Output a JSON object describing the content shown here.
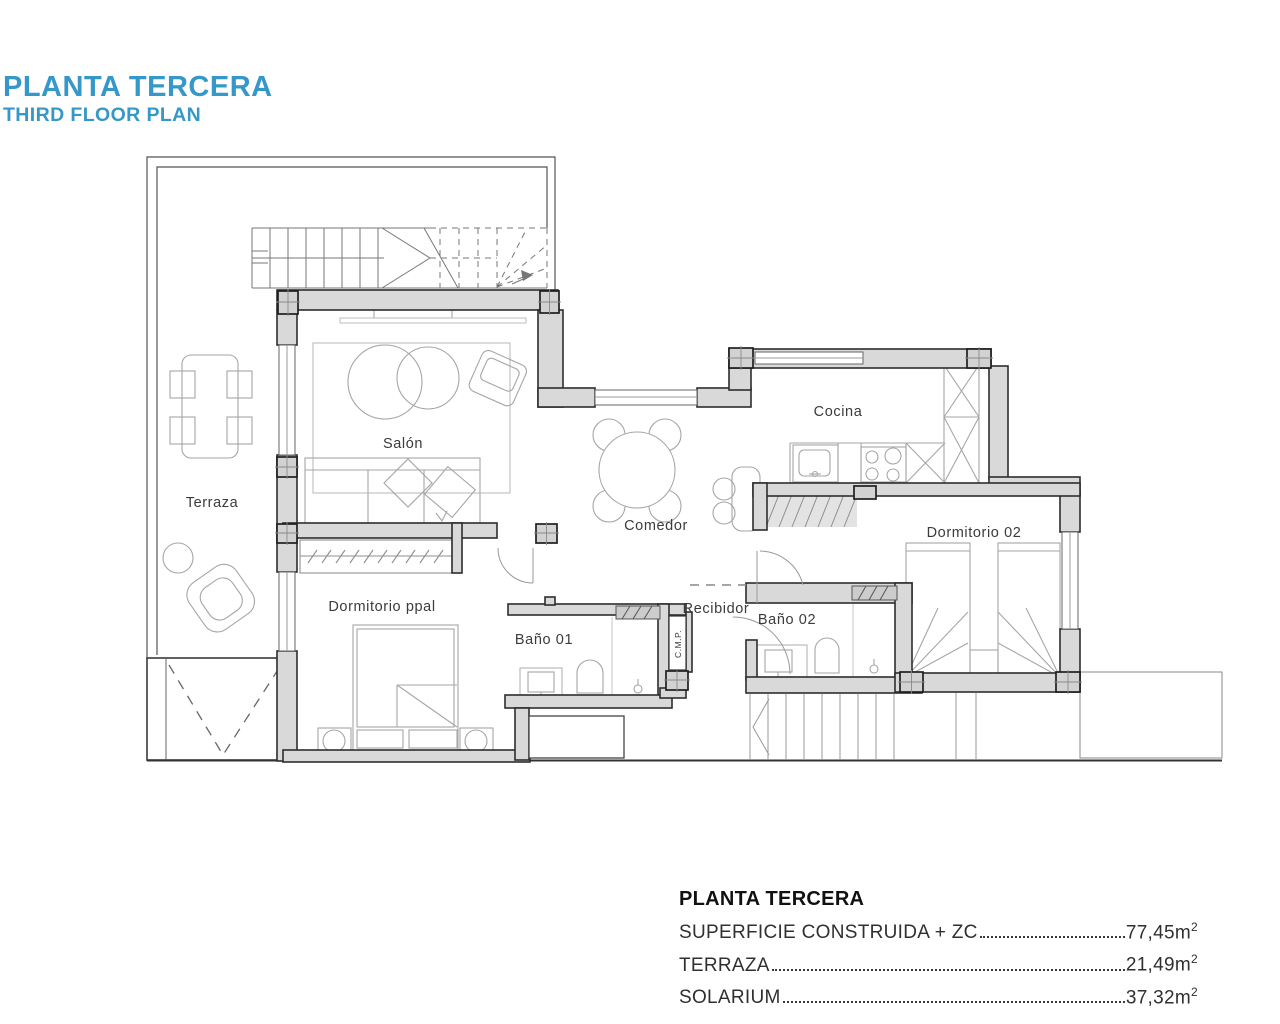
{
  "header": {
    "title_primary": "PLANTA TERCERA",
    "title_secondary": "THIRD FLOOR PLAN",
    "accent_color": "#3598c8"
  },
  "rooms": {
    "terraza": "Terraza",
    "salon": "Salón",
    "comedor": "Comedor",
    "cocina": "Cocina",
    "recibidor": "Recibidor",
    "bano01": "Baño 01",
    "bano02": "Baño 02",
    "dormitorio_ppal": "Dormitorio ppal",
    "dormitorio_02": "Dormitorio 02",
    "cmp_shaft": "C.M.P."
  },
  "summary": {
    "title": "PLANTA TERCERA",
    "rows": [
      {
        "label": "SUPERFICIE CONSTRUIDA + ZC",
        "value": "77,45m",
        "sup": "2"
      },
      {
        "label": "TERRAZA",
        "value": "21,49m",
        "sup": "2"
      },
      {
        "label": "SOLARIUM",
        "value": "37,32m",
        "sup": "2"
      }
    ]
  },
  "plan_colors": {
    "wall_fill": "#d9d9d9",
    "wall_stroke": "#2d2d2d",
    "furniture_stroke": "#a0a0a0"
  }
}
